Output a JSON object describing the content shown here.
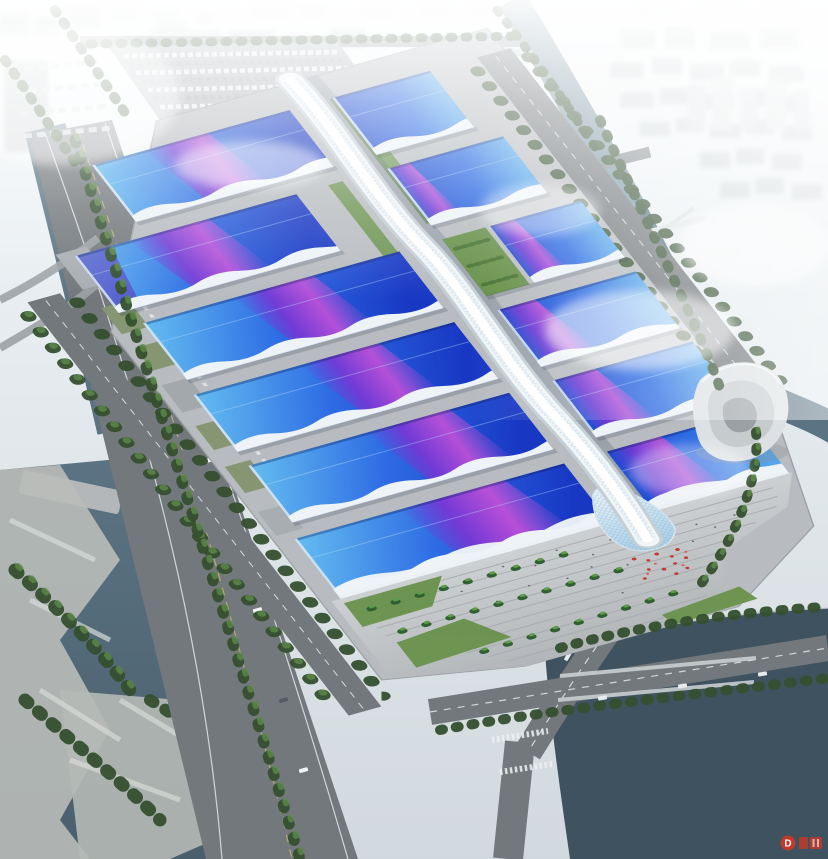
{
  "meta": {
    "description": "Aerial rendering of a large exhibition center: paired rows of blue wave-form hall roofs crossed by a violet ribbon, a white serpentine central pedestrian spine, a stepped entrance plaza with palms and red decorations, surrounded by rivers, an expressway, a spiral landmark building and a hazy white city skyline."
  },
  "colors": {
    "sky": "#e7edf0",
    "fog": "#f4f8fa",
    "water_main": "#5b7382",
    "water_dark": "#4a5f6e",
    "water_deep": "#3e525f",
    "water_light": "#7b96a4",
    "road": "#73787c",
    "road_light": "#8d9296",
    "lane_white": "#e9edef",
    "lane_yellow": "#c9bd72",
    "slab": "#b8bcc0",
    "plaza": "#c4c7ca",
    "city_block": "#d3d9dc",
    "city_far": "#e7ebee",
    "tower_gray": "#bcc2c6",
    "tree_dark": "#344f2e",
    "tree_light": "#5d8a48",
    "lawn": "#679049",
    "roof_light": "#64bdf0",
    "roof_mid": "#2e6ce4",
    "roof_deep": "#1838c4",
    "ribbon_violet": "#7b35d4",
    "ribbon_magenta": "#c84fd8",
    "fascia": "#edf3f7",
    "spine": "#f0f5f8",
    "spine_shade": "#c3ced5",
    "service_green": "#879672",
    "red_accent": "#c13a2d",
    "swirl": "#dde1e4"
  },
  "complex": {
    "hall_rows": 6,
    "west_halls": 6,
    "east_halls": 6,
    "spine_label": "central-canopy-spine"
  },
  "watermark": {
    "letter": "D",
    "color": "#c0392b"
  }
}
